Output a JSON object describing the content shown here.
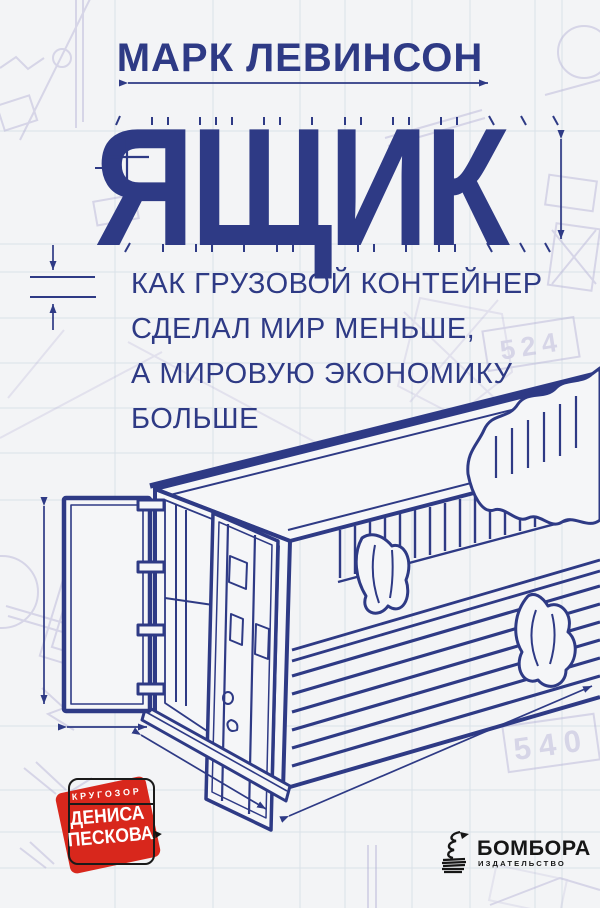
{
  "cover": {
    "author": "МАРК ЛЕВИНСОН",
    "title": "ЯЩИК",
    "subtitle": [
      "КАК ГРУЗОВОЙ КОНТЕЙНЕР",
      "СДЕЛАЛ МИР МЕНЬШЕ,",
      "А МИРОВУЮ ЭКОНОМИКУ",
      "БОЛЬШЕ"
    ]
  },
  "badge": {
    "series": "КРУГОЗОР",
    "curator_line1": "ДЕНИСА",
    "curator_line2": "ПЕСКОВА",
    "arrow": "▶"
  },
  "publisher": {
    "name": "БОМБОРА",
    "tagline": "ИЗДАТЕЛЬСТВО"
  },
  "blueprint_labels": {
    "dim_a": "524",
    "dim_b": "540"
  },
  "colors": {
    "ink": "#2e3a85",
    "red": "#d8271c",
    "black": "#1a1a1a",
    "paper": "#f3f4f6",
    "grid": "#c8d7e0",
    "sketch": "#b3aed4"
  }
}
